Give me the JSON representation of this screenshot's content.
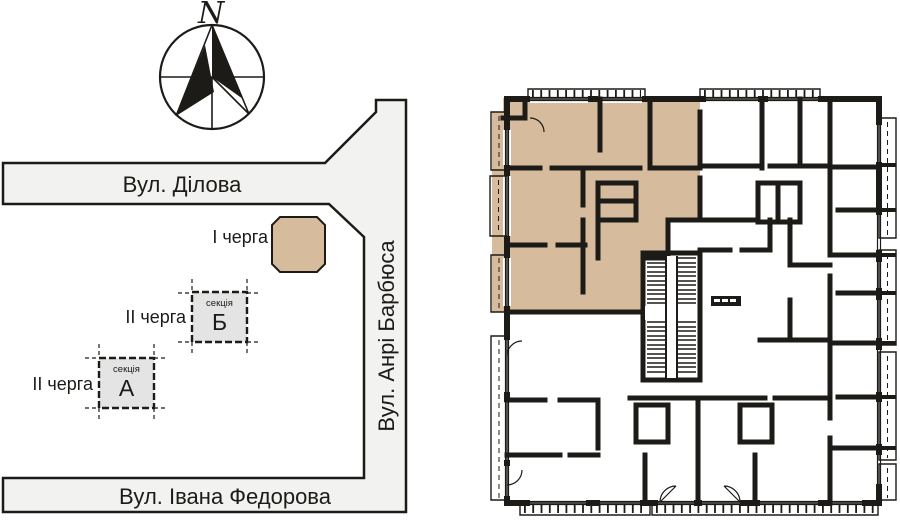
{
  "site_plan": {
    "compass": {
      "north_label": "N"
    },
    "streets": [
      {
        "name": "Вул. Ділова",
        "orientation": "horizontal-top"
      },
      {
        "name": "Вул. Анрі Барбюса",
        "orientation": "vertical-right"
      },
      {
        "name": "Вул. Івана Федорова",
        "orientation": "horizontal-bottom"
      }
    ],
    "legend_buildings": [
      {
        "phase_label": "І черга",
        "highlighted": true
      },
      {
        "phase_label": "ІІ черга",
        "section_caption": "секція",
        "section_letter": "Б"
      },
      {
        "phase_label": "ІІ черга",
        "section_caption": "секція",
        "section_letter": "А"
      }
    ]
  },
  "floor_plan": {
    "highlighted_apartment": {
      "location": "upper-left",
      "highlighted": true
    }
  },
  "colors": {
    "accent_tan": "#d6bc9c",
    "wall_black": "#1d1b17",
    "street_gray": "#f2f2f1",
    "building_gray": "#e4e4e4"
  }
}
